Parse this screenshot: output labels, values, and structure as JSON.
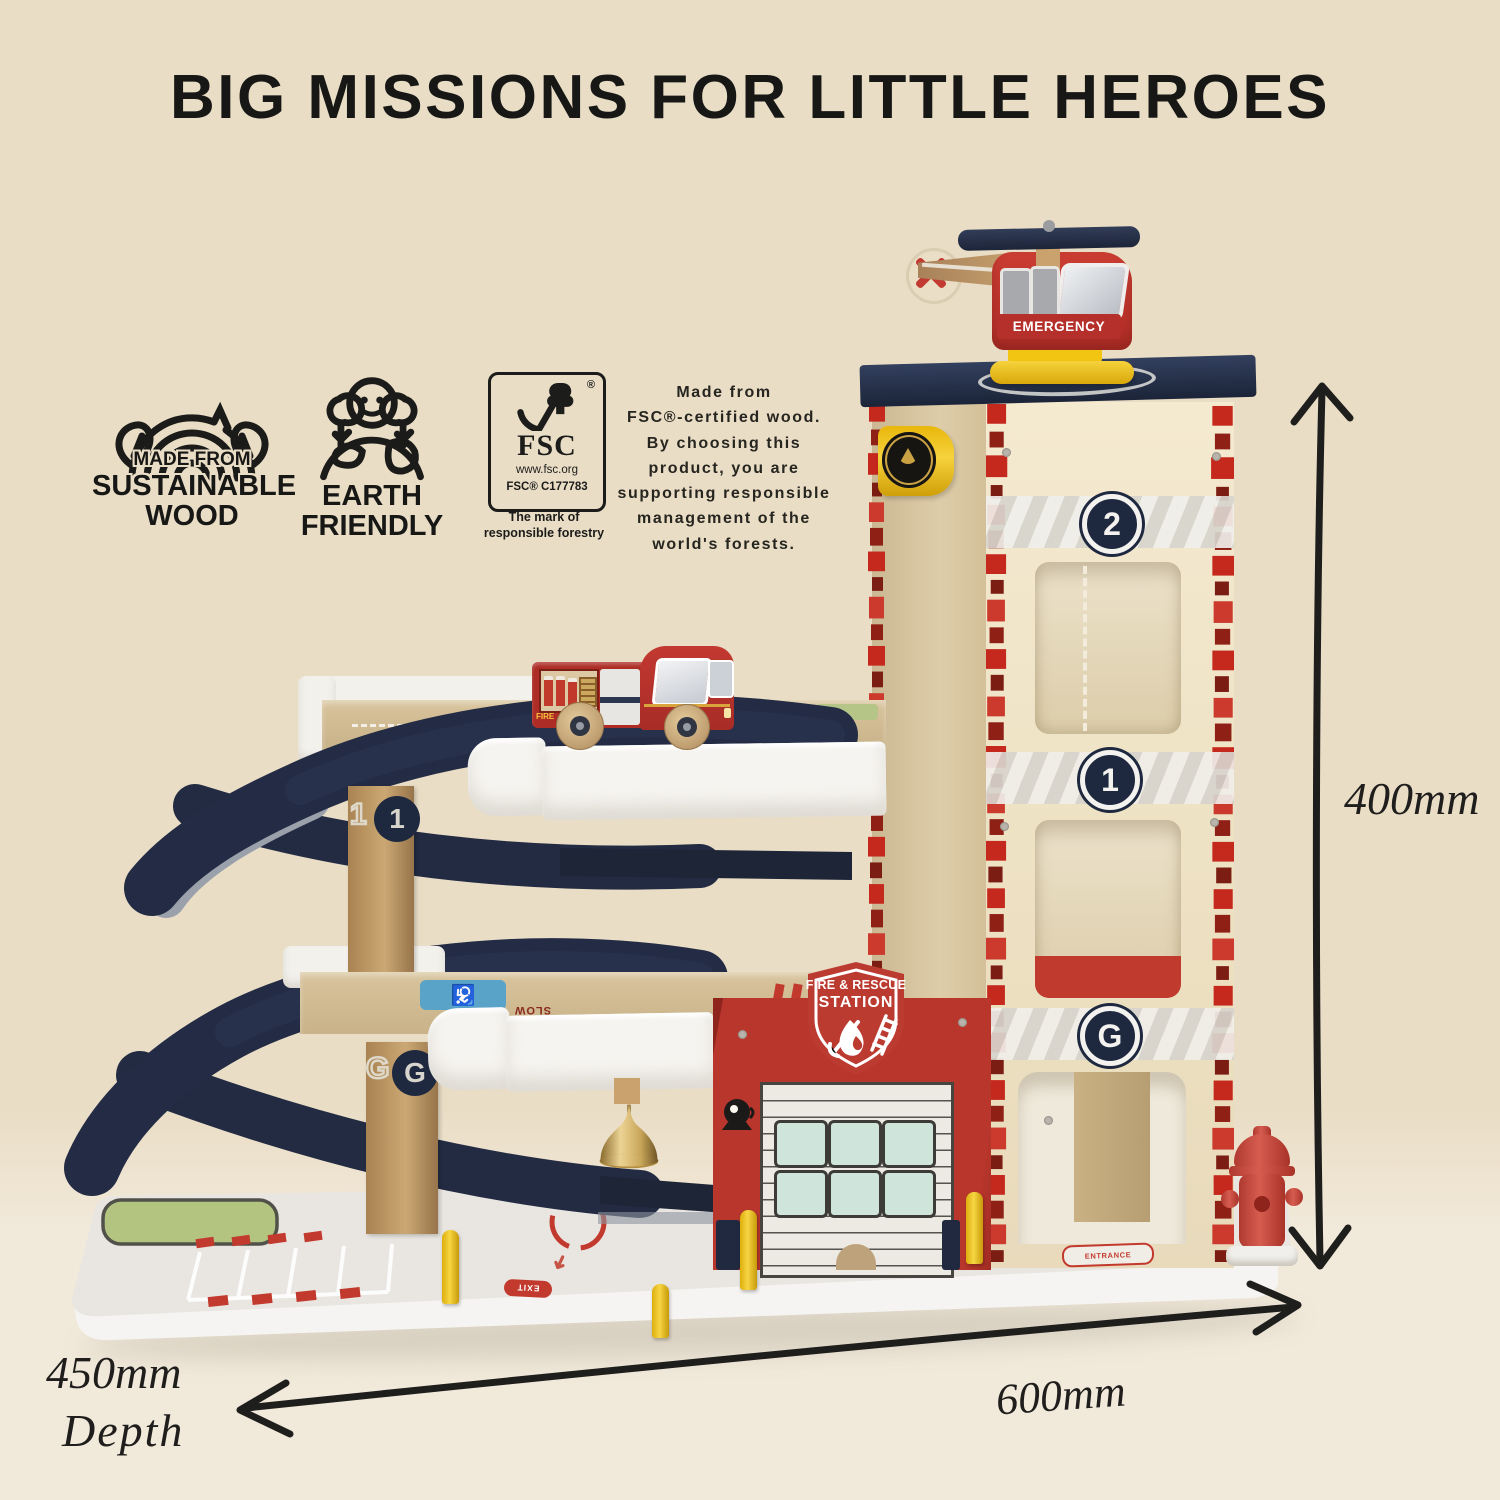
{
  "title": "BIG MISSIONS FOR LITTLE HEROES",
  "badges": {
    "sustainable": {
      "top": "MADE FROM",
      "middle": "SUSTAINABLE",
      "bottom": "WOOD"
    },
    "earth": {
      "top": "EARTH",
      "bottom": "FRIENDLY"
    },
    "fsc": {
      "acronym": "FSC",
      "url": "www.fsc.org",
      "license": "FSC® C177783",
      "registered_mark": "®",
      "tagline": "The mark of\nresponsible forestry"
    }
  },
  "description": "Made from\nFSC®-certified wood.\nBy choosing this\nproduct, you are\nsupporting responsible\nmanagement of the\nworld's forests.",
  "dimensions": {
    "height": "400mm",
    "width": "600mm",
    "depth": "450mm",
    "depth_label": "Depth"
  },
  "toy": {
    "helicopter_label": "EMERGENCY",
    "floor_2": "2",
    "floor_1": "1",
    "floor_g": "G",
    "shield_line1": "FIRE & RESCUE",
    "shield_line2": "STATION",
    "truck_label": "FIRE",
    "marking_slow": "SLOW",
    "marking_exit": "EXIT",
    "marking_entrance": "ENTRANCE",
    "handicap_symbol": "♿"
  },
  "colors": {
    "background": "#e9ddc6",
    "floor": "#f1e9da",
    "navy": "#222b42",
    "station_red": "#b8362c",
    "brick_red": "#c5281d",
    "tower_cream": "#f2e7ca",
    "wood": "#c5a376",
    "accent_yellow": "#f2c518",
    "window_mint": "#cfe4da",
    "bell_gold": "#c9a75a",
    "ink": "#1c1c1a"
  }
}
